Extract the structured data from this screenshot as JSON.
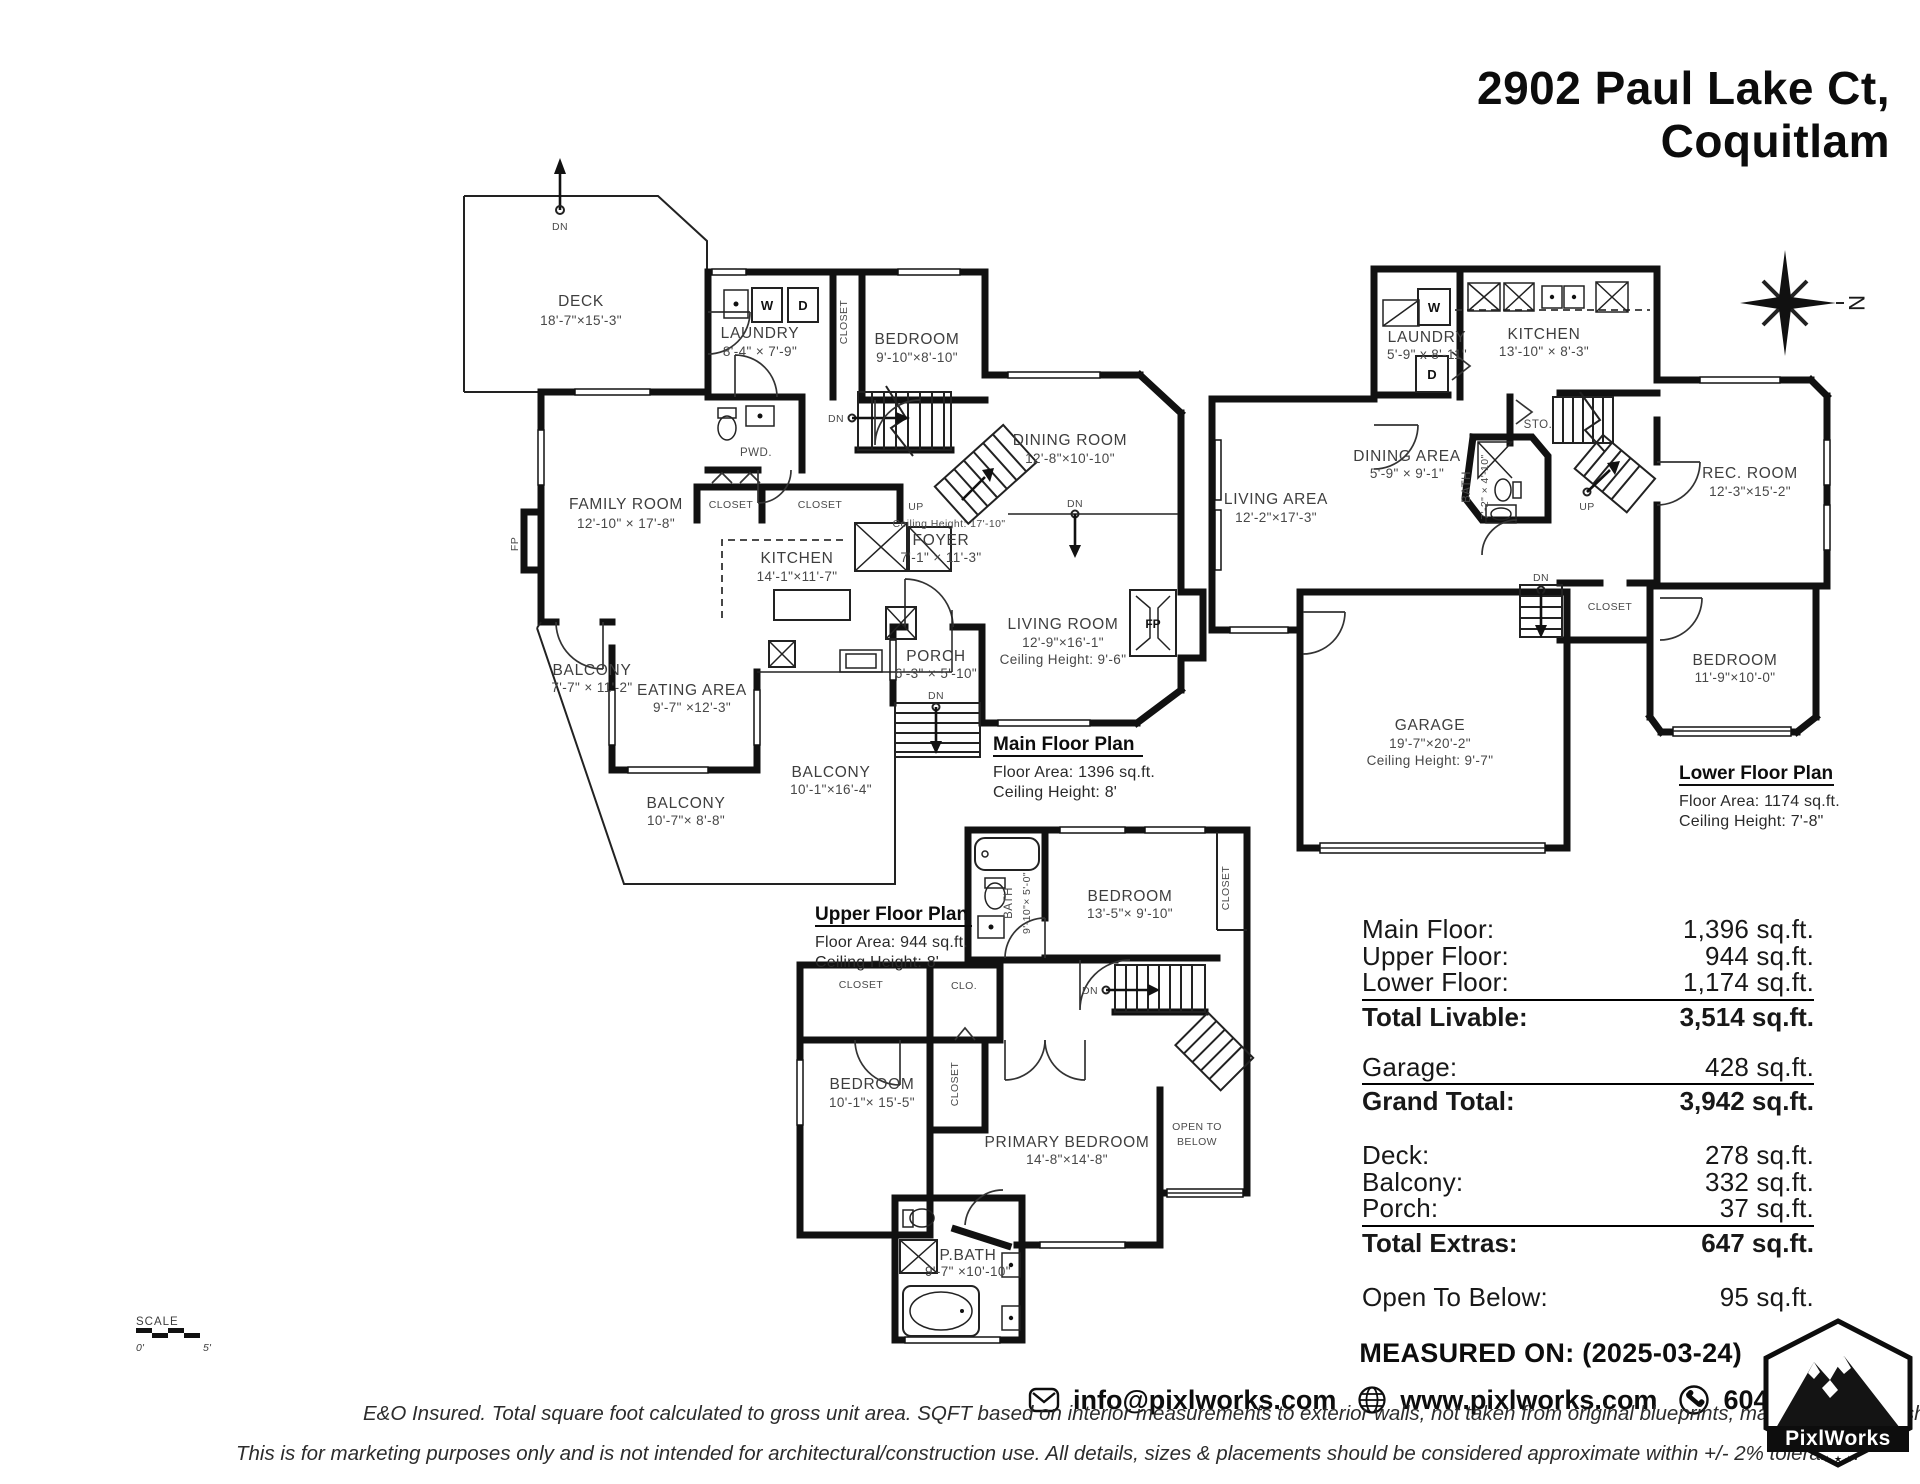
{
  "title": {
    "line1": "2902 Paul Lake Ct,",
    "line2": "Coquitlam"
  },
  "mf": {
    "heading": "Main Floor Plan",
    "area": "Floor Area: 1396 sq.ft.",
    "ceiling": "Ceiling Height: 8'",
    "deck": "DECK",
    "deck_d": "18'-7\"×15'-3\"",
    "dn_deck": "DN",
    "laundry": "LAUNDRY",
    "laundry_d": "8'-4\" × 7'-9\"",
    "w": "W",
    "d": "D",
    "closet_v": "CLOSET",
    "bedroom": "BEDROOM",
    "bedroom_d": "9'-10\"×8'-10\"",
    "pwd": "PWD.",
    "dn_stairs": "DN",
    "up": "UP",
    "family": "FAMILY ROOM",
    "family_d": "12'-10\" × 17'-8\"",
    "closet1": "CLOSET",
    "closet2": "CLOSET",
    "ceil_foyer": "Ceiling Height: 17'-10\"",
    "foyer": "FOYER",
    "foyer_d": "7'-1\" × 11'-3\"",
    "kitchen": "KITCHEN",
    "kitchen_d": "14'-1\"×11'-7\"",
    "dining": "DINING ROOM",
    "dining_d": "12'-8\"×10'-10\"",
    "dn_dining": "DN",
    "living": "LIVING ROOM",
    "living_d": "12'-9\"×16'-1\"",
    "living_ch": "Ceiling Height: 9'-6\"",
    "fp": "FP",
    "fp_side": "FP",
    "porch": "PORCH",
    "porch_d": "6'-3\" × 5'-10\"",
    "dn_porch": "DN",
    "balcony1": "BALCONY",
    "balcony1_d": "7'-7\" × 11'-2\"",
    "eating": "EATING AREA",
    "eating_d": "9'-7\" ×12'-3\"",
    "balcony2": "BALCONY",
    "balcony2_d": "10'-1\"×16'-4\"",
    "balcony3": "BALCONY",
    "balcony3_d": "10'-7\"× 8'-8\""
  },
  "lf": {
    "heading": "Lower Floor Plan",
    "area": "Floor Area: 1174 sq.ft.",
    "ceiling": "Ceiling Height: 7'-8\"",
    "laundry": "LAUNDRY",
    "laundry_d": "5'-9\" x 8'-11\"",
    "w": "W",
    "d": "D",
    "kitchen": "KITCHEN",
    "kitchen_d": "13'-10\" × 8'-3\"",
    "living": "LIVING AREA",
    "living_d": "12'-2\"×17'-3\"",
    "dining": "DINING AREA",
    "dining_d": "5'-9\" × 9'-1\"",
    "sto": "STO.",
    "bath": "BATH",
    "bath_d": "7'-2\" × 4'-10\"",
    "up": "UP",
    "dn": "DN",
    "closet": "CLOSET",
    "rec": "REC. ROOM",
    "rec_d": "12'-3\"×15'-2\"",
    "bedroom": "BEDROOM",
    "bedroom_d": "11'-9\"×10'-0\"",
    "garage": "GARAGE",
    "garage_d": "19'-7\"×20'-2\"",
    "garage_ch": "Ceiling Height: 9'-7\""
  },
  "uf": {
    "heading": "Upper Floor Plan",
    "area": "Floor Area: 944 sq.ft.",
    "ceiling": "Ceiling Height: 8'",
    "bath": "BATH",
    "bath_d": "9'-10\"× 5'-0\"",
    "bedroom1": "BEDROOM",
    "bedroom1_d": "13'-5\"× 9'-10\"",
    "closet_r": "CLOSET",
    "closet_l": "CLOSET",
    "clo": "CLO.",
    "closet_m": "CLOSET",
    "bedroom2": "BEDROOM",
    "bedroom2_d": "10'-1\"× 15'-5\"",
    "primary": "PRIMARY BEDROOM",
    "primary_d": "14'-8\"×14'-8\"",
    "dn": "DN",
    "open1": "OPEN TO",
    "open2": "BELOW",
    "pbath": "P.BATH",
    "pbath_d": "9'-7\" ×10'-10\""
  },
  "summary": {
    "groups": [
      {
        "rows": [
          {
            "label": "Main Floor:",
            "value": "1,396 sq.ft."
          },
          {
            "label": "Upper Floor:",
            "value": "944 sq.ft."
          },
          {
            "label": "Lower Floor:",
            "value": "1,174 sq.ft."
          }
        ],
        "total": {
          "label": "Total Livable:",
          "value": "3,514 sq.ft."
        }
      },
      {
        "rows": [
          {
            "label": "Garage:",
            "value": "428 sq.ft."
          }
        ],
        "total": {
          "label": "Grand Total:",
          "value": "3,942 sq.ft."
        }
      },
      {
        "rows": [
          {
            "label": "Deck:",
            "value": "278 sq.ft."
          },
          {
            "label": "Balcony:",
            "value": "332 sq.ft."
          },
          {
            "label": "Porch:",
            "value": "37 sq.ft."
          }
        ],
        "total": {
          "label": "Total Extras:",
          "value": "647 sq.ft."
        }
      },
      {
        "rows": [
          {
            "label": "Open To Below:",
            "value": "95 sq.ft."
          }
        ]
      }
    ]
  },
  "footer": {
    "measured": "MEASURED ON: (2025-03-24)",
    "email": "info@pixlworks.com",
    "web": "www.pixlworks.com",
    "phone": "604.329.5788",
    "disc1": "E&O Insured.  Total square foot calculated to gross unit area. SQFT based on interior measurements to exterior walls, not taken from original blueprints, may include unfinished area.",
    "disc2": "This is for marketing purposes only and is not intended for architectural/construction use.  All details, sizes & placements should be considered approximate within +/- 2%  tolerance."
  },
  "logo": {
    "brand": "PixlWorks",
    "stars": "★ ★ ★"
  },
  "scale": {
    "label": "SCALE",
    "from": "0'",
    "to": "5'"
  },
  "compass": {
    "n": "N"
  }
}
